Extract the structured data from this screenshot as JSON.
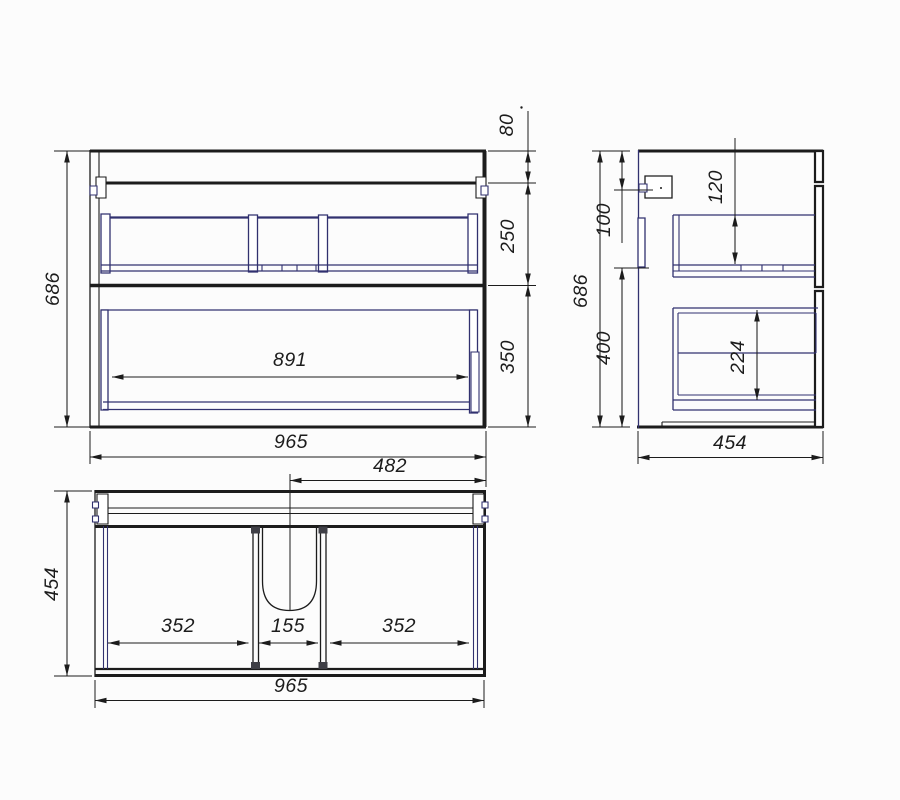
{
  "drawing": {
    "kind": "cabinet-three-view-technical-drawing",
    "views": [
      "front",
      "side",
      "plan"
    ]
  },
  "dims": {
    "front": {
      "height": "686",
      "top_rail": "80",
      "upper_front": "250",
      "lower_front": "350",
      "inner_width": "891",
      "width": "965"
    },
    "side": {
      "height": "686",
      "hanger": "100",
      "lower_zone": "400",
      "upper_inner": "120",
      "lower_inner": "224",
      "depth": "454"
    },
    "plan": {
      "center_right": "482",
      "depth": "454",
      "left_bay": "352",
      "middle_bay": "155",
      "right_bay": "352",
      "width": "965"
    }
  },
  "colors": {
    "line": "#1c1c1c",
    "accent": "#31316f",
    "cap": "#3f3f46",
    "background": "#fcfcfc"
  }
}
